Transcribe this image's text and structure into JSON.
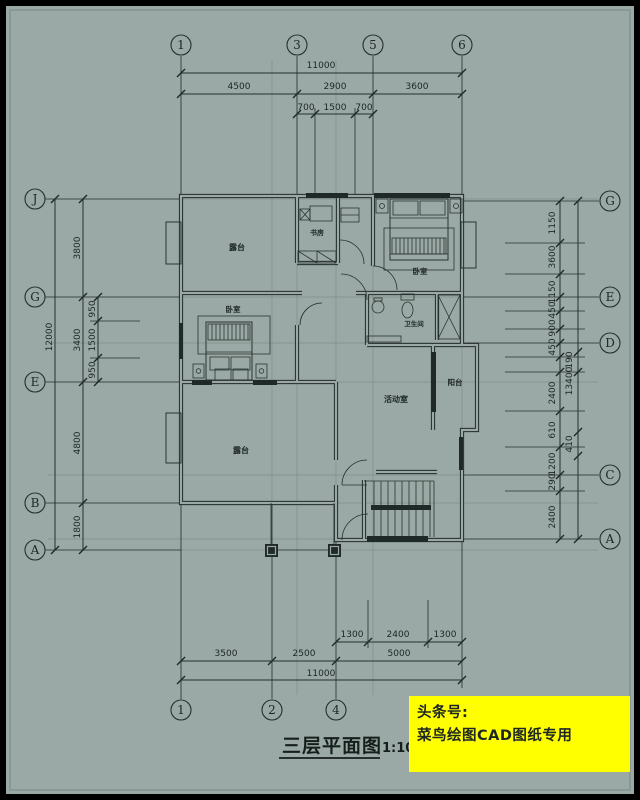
{
  "colors": {
    "background": "#9aa9a5",
    "line": "#26302d",
    "watermark_bg": "#ffff00",
    "watermark_text": "#e23508"
  },
  "title": {
    "text": "三层平面图",
    "scale": "1:100"
  },
  "watermark": {
    "line1": "头条号:",
    "line2": "菜鸟绘图CAD图纸专用"
  },
  "axis_bubbles": {
    "top": [
      {
        "label": "1",
        "x": 181
      },
      {
        "label": "3",
        "x": 297
      },
      {
        "label": "5",
        "x": 373
      },
      {
        "label": "6",
        "x": 462
      }
    ],
    "bottom": [
      {
        "label": "1",
        "x": 181
      },
      {
        "label": "2",
        "x": 272
      },
      {
        "label": "4",
        "x": 336
      }
    ],
    "left": [
      {
        "label": "J",
        "y": 199
      },
      {
        "label": "G",
        "y": 297
      },
      {
        "label": "E",
        "y": 382
      },
      {
        "label": "B",
        "y": 503
      },
      {
        "label": "A",
        "y": 550
      }
    ],
    "right": [
      {
        "label": "G",
        "y": 201
      },
      {
        "label": "E",
        "y": 297
      },
      {
        "label": "D",
        "y": 343
      },
      {
        "label": "C",
        "y": 475
      },
      {
        "label": "A",
        "y": 539
      }
    ]
  },
  "dimensions": {
    "top": [
      {
        "text": "11000",
        "x": 321,
        "y": 68
      },
      {
        "text": "4500",
        "x": 239,
        "y": 89
      },
      {
        "text": "2900",
        "x": 335,
        "y": 89
      },
      {
        "text": "3600",
        "x": 417,
        "y": 89
      },
      {
        "text": "700",
        "x": 306,
        "y": 110
      },
      {
        "text": "1500",
        "x": 335,
        "y": 110
      },
      {
        "text": "700",
        "x": 364,
        "y": 110
      }
    ],
    "bottom": [
      {
        "text": "1300",
        "x": 352,
        "y": 637
      },
      {
        "text": "2400",
        "x": 398,
        "y": 637
      },
      {
        "text": "1300",
        "x": 445,
        "y": 637
      },
      {
        "text": "3500",
        "x": 226,
        "y": 656
      },
      {
        "text": "2500",
        "x": 304,
        "y": 656
      },
      {
        "text": "5000",
        "x": 399,
        "y": 656
      },
      {
        "text": "11000",
        "x": 321,
        "y": 676
      }
    ],
    "left": [
      {
        "text": "12000",
        "x": 52,
        "y": 337
      },
      {
        "text": "3800",
        "x": 80,
        "y": 248
      },
      {
        "text": "3400",
        "x": 80,
        "y": 340
      },
      {
        "text": "4800",
        "x": 80,
        "y": 443
      },
      {
        "text": "1800",
        "x": 80,
        "y": 527
      },
      {
        "text": "950",
        "x": 95,
        "y": 309
      },
      {
        "text": "1500",
        "x": 95,
        "y": 340
      },
      {
        "text": "950",
        "x": 95,
        "y": 370
      }
    ],
    "right": [
      {
        "text": "1150",
        "x": 555,
        "y": 223
      },
      {
        "text": "3600",
        "x": 555,
        "y": 257
      },
      {
        "text": "1150",
        "x": 555,
        "y": 292
      },
      {
        "text": "450",
        "x": 555,
        "y": 310
      },
      {
        "text": "900",
        "x": 555,
        "y": 328
      },
      {
        "text": "450",
        "x": 555,
        "y": 347
      },
      {
        "text": "2400",
        "x": 555,
        "y": 393
      },
      {
        "text": "610",
        "x": 555,
        "y": 430
      },
      {
        "text": "1200",
        "x": 555,
        "y": 464
      },
      {
        "text": "290",
        "x": 555,
        "y": 482
      },
      {
        "text": "2400",
        "x": 555,
        "y": 517
      },
      {
        "text": "190",
        "x": 572,
        "y": 360
      },
      {
        "text": "13400",
        "x": 572,
        "y": 381
      },
      {
        "text": "410",
        "x": 572,
        "y": 444
      }
    ]
  },
  "rooms": [
    {
      "key": "terrace-top",
      "label": "露台",
      "x": 237,
      "y": 250,
      "fs": 8
    },
    {
      "key": "study",
      "label": "书房",
      "x": 317,
      "y": 235,
      "fs": 7
    },
    {
      "key": "bedroom-top",
      "label": "卧室",
      "x": 420,
      "y": 274,
      "fs": 7.5
    },
    {
      "key": "bedroom-mid",
      "label": "卧室",
      "x": 233,
      "y": 312,
      "fs": 7.5
    },
    {
      "key": "bathroom",
      "label": "卫生间",
      "x": 414,
      "y": 326,
      "fs": 6.5
    },
    {
      "key": "activity-room",
      "label": "活动室",
      "x": 396,
      "y": 402,
      "fs": 8
    },
    {
      "key": "balcony",
      "label": "阳台",
      "x": 455,
      "y": 385,
      "fs": 7.5
    },
    {
      "key": "terrace-bottom",
      "label": "露台",
      "x": 241,
      "y": 453,
      "fs": 8
    }
  ]
}
